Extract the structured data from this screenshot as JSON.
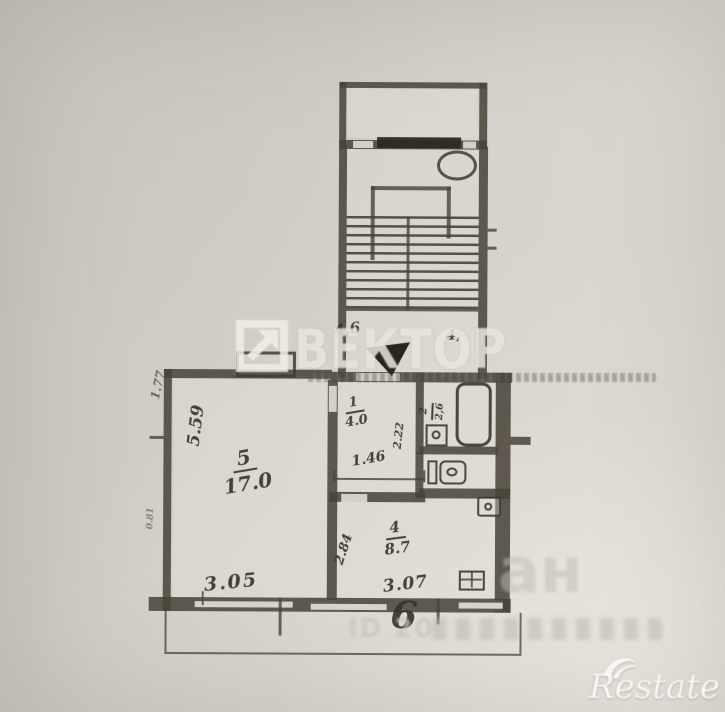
{
  "photo": {
    "watermark_agency": "ВЕКТОР",
    "watermark_portal_fragment": "ан",
    "watermark_listing_id": "ID 20",
    "watermark_brand": "Restate"
  },
  "plan": {
    "landing": {
      "dim_left": "4,6",
      "dim_right": "4,"
    },
    "living": {
      "number": "5",
      "area": "17.0",
      "side": "5.59",
      "width": "3.05"
    },
    "hall": {
      "number": "1",
      "area": "4.0",
      "width": "1.46",
      "depth": "2.22"
    },
    "bath": {
      "number": "2",
      "area": "2,6"
    },
    "kitchen": {
      "number": "4",
      "area": "8.7",
      "width": "3.07",
      "side": "2.84"
    },
    "balcony": {
      "number": "6"
    },
    "edges": {
      "top_left": "1.77",
      "bottom_left": "0.81"
    }
  }
}
